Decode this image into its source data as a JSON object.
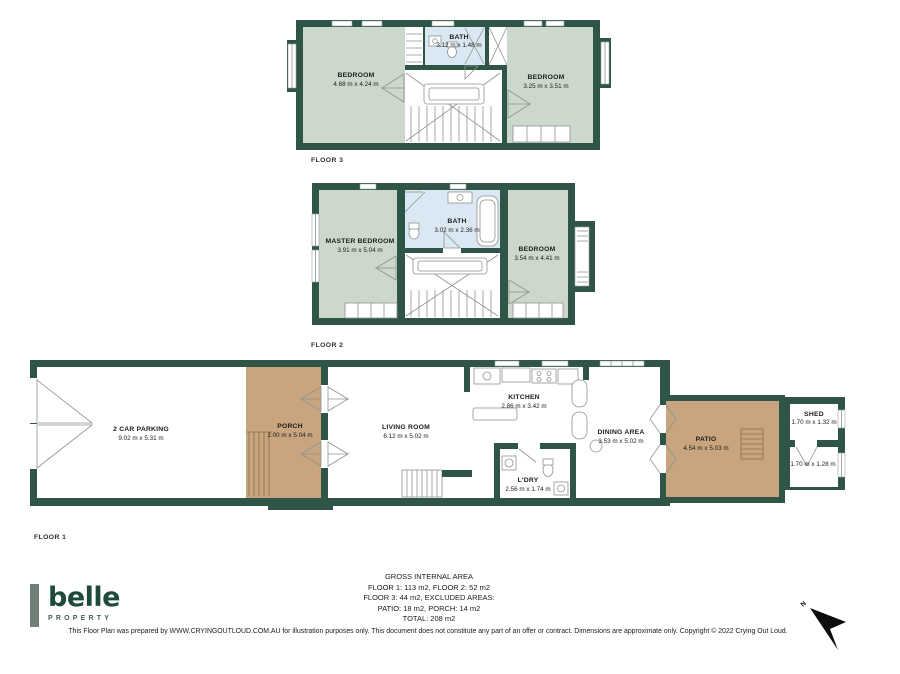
{
  "colors": {
    "wall_green": "#2e5546",
    "room_green": "#ccd8cb",
    "bath_blue": "#d9e8f2",
    "outdoor_tan": "#c8a57e",
    "logo_green": "#1e4a3c",
    "logo_bar_green": "#6f8174"
  },
  "floors": {
    "floor3": {
      "label": "FLOOR 3",
      "rooms": {
        "bedroom_left": {
          "name": "BEDROOM",
          "dims": "4.68 m x 4.24 m"
        },
        "bath": {
          "name": "BATH",
          "dims": "3.12 m x 1.48 m"
        },
        "bedroom_right": {
          "name": "BEDROOM",
          "dims": "3.25 m x 3.51 m"
        }
      }
    },
    "floor2": {
      "label": "FLOOR 2",
      "rooms": {
        "master_bedroom": {
          "name": "MASTER BEDROOM",
          "dims": "3.91 m x 5.04 m"
        },
        "bath": {
          "name": "BATH",
          "dims": "3.02 m x 2.36 m"
        },
        "bedroom": {
          "name": "BEDROOM",
          "dims": "3.54 m x 4.41 m"
        }
      }
    },
    "floor1": {
      "label": "FLOOR 1",
      "rooms": {
        "parking": {
          "name": "2 CAR PARKING",
          "dims": "9.02 m x 5.31 m"
        },
        "porch": {
          "name": "PORCH",
          "dims": "2.00 m x 5.04 m"
        },
        "living": {
          "name": "LIVING ROOM",
          "dims": "6.12 m x 5.02 m"
        },
        "kitchen": {
          "name": "KITCHEN",
          "dims": "2.86 m x 3.42 m"
        },
        "laundry": {
          "name": "L'DRY",
          "dims": "2.56 m x 1.74 m"
        },
        "dining": {
          "name": "DINING AREA",
          "dims": "3.53 m x 5.02 m"
        },
        "patio": {
          "name": "PATIO",
          "dims": "4.54 m x 5.03 m"
        },
        "shed": {
          "name": "SHED",
          "dims": "1.70 m x 1.32 m"
        },
        "store": {
          "name": "",
          "dims": "1.70 m x 1.28 m"
        }
      }
    }
  },
  "summary": {
    "lines": [
      "GROSS INTERNAL AREA",
      "FLOOR 1: 113 m2, FLOOR 2: 52 m2",
      "FLOOR 3: 44 m2, EXCLUDED AREAS:",
      "PATIO: 18 m2, PORCH: 14 m2",
      "TOTAL: 208 m2"
    ]
  },
  "disclaimer": "This Floor Plan was prepared by WWW.CRYINGOUTLOUD.COM.AU for illustration purposes only. This document does not constitute any part of an offer or contract. Dimensions are approximate only. Copyright © 2022 Crying Out Loud.",
  "brand": {
    "name": "belle",
    "tagline": "PROPERTY"
  },
  "compass": {
    "label": "N"
  }
}
